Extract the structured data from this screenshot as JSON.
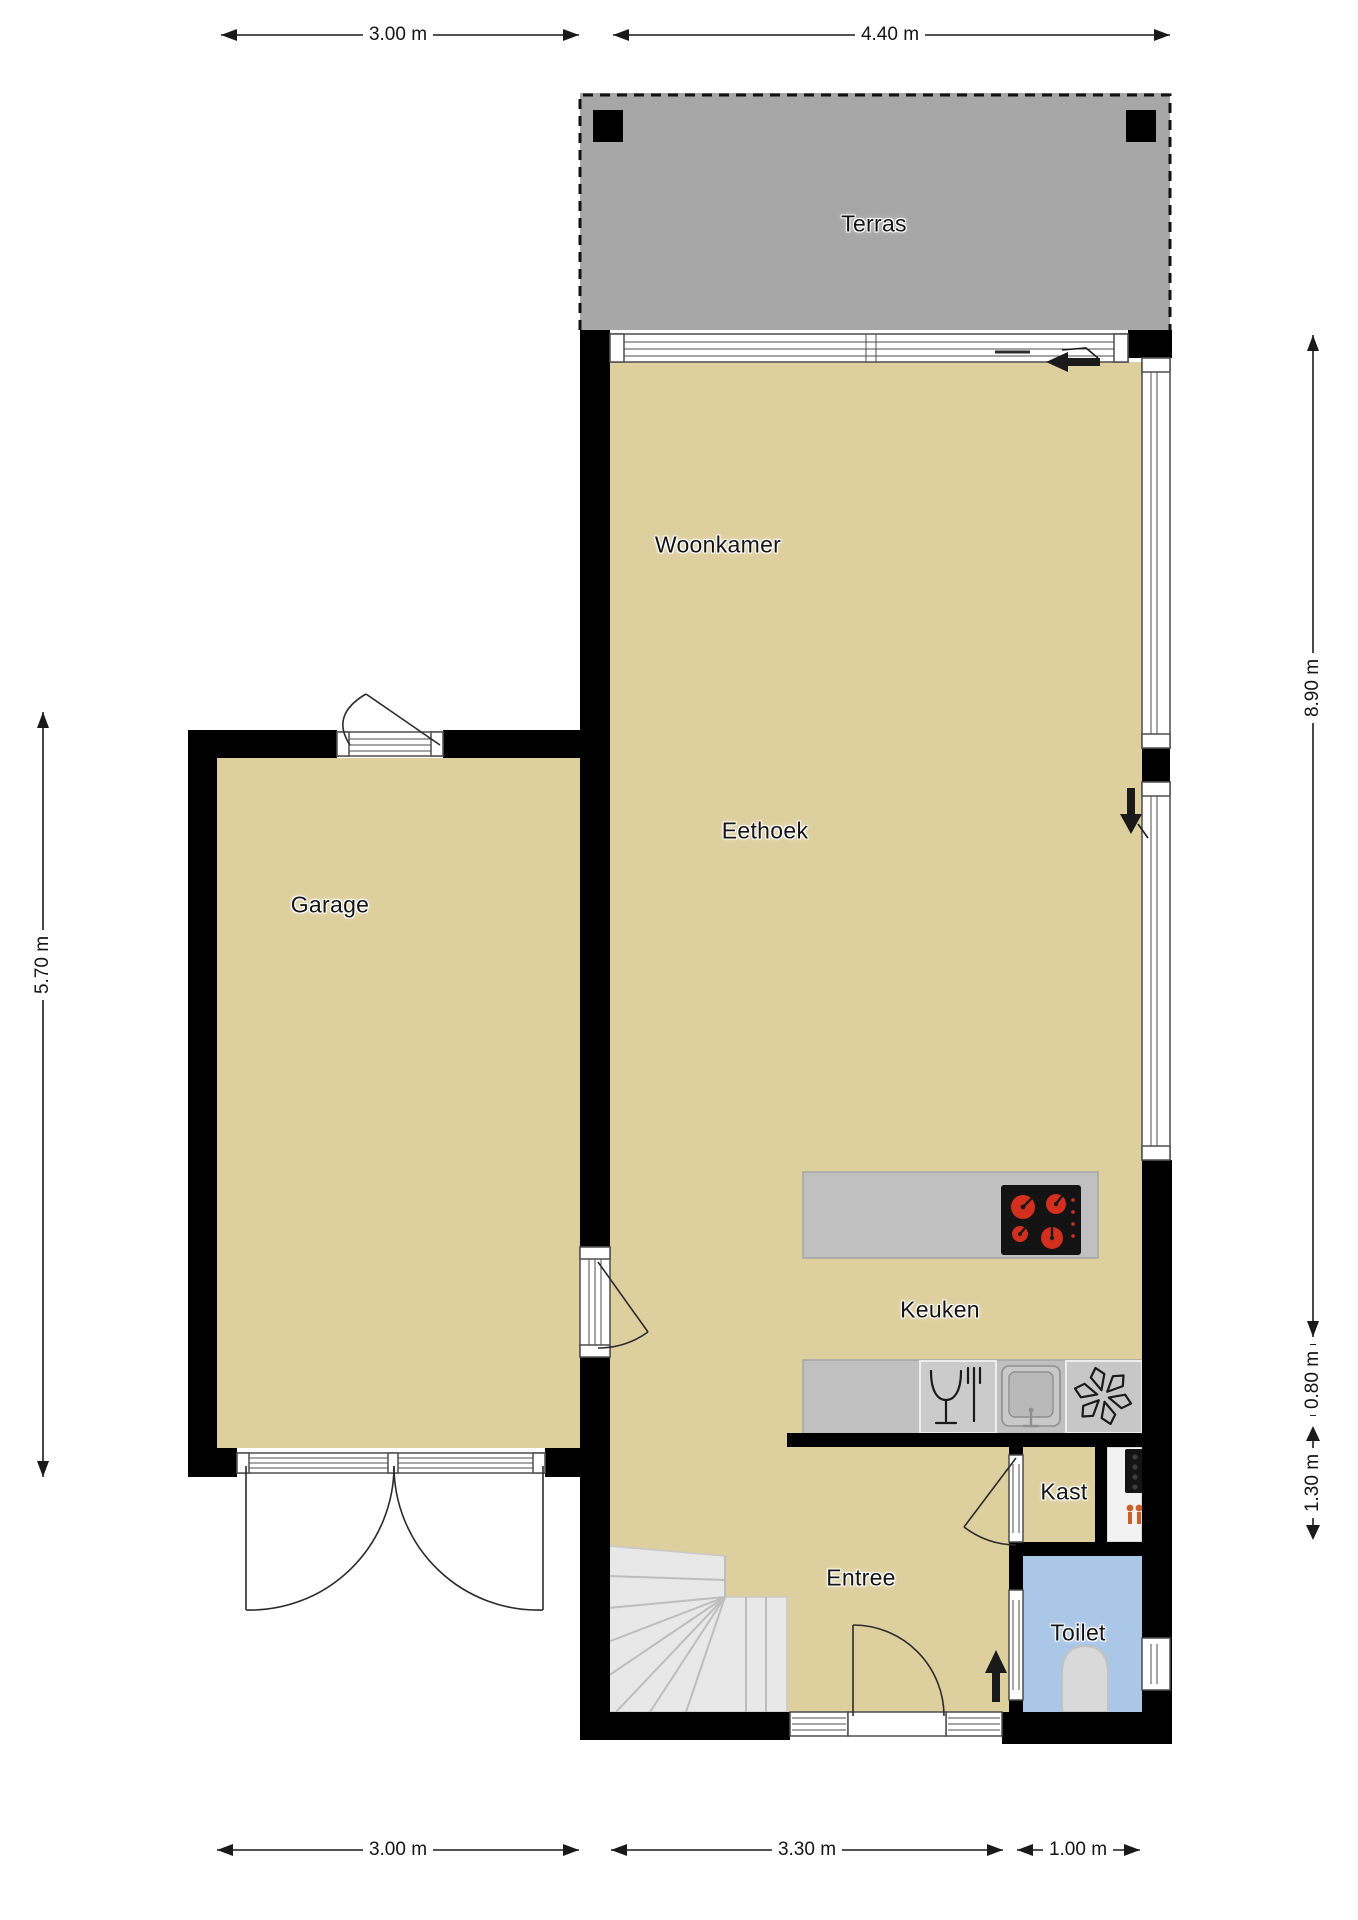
{
  "palette": {
    "wall": "#000000",
    "floor": "#decf9e",
    "terrace": "#a7a7a7",
    "toilet_floor": "#aac7e8",
    "counter": "#c0c0c0",
    "stairs": "#e8e8e8",
    "fixture": "#d9d9d9",
    "burner_red": "#d32f1f",
    "valve_orange": "#cc5f2a",
    "line": "#1a1a1a"
  },
  "rooms": {
    "terras": "Terras",
    "woonkamer": "Woonkamer",
    "eethoek": "Eethoek",
    "garage": "Garage",
    "keuken": "Keuken",
    "kast": "Kast",
    "entree": "Entree",
    "toilet": "Toilet"
  },
  "dimensions": {
    "top": [
      "3.00 m",
      "4.40 m"
    ],
    "bottom": [
      "3.00 m",
      "3.30 m",
      "1.00 m"
    ],
    "left": [
      "5.70 m"
    ],
    "right": [
      "8.90 m",
      "0.80 m",
      "1.30 m"
    ]
  },
  "icons": {
    "cooktop": "black hob with 4 red burners",
    "dishwasher": "wine glass and fork outline",
    "sink": "square basin with tap",
    "extractor_fan": "six-blade fan outline",
    "toilet": "wc pan, rounded top",
    "boiler": "black meter-cabinet unit",
    "valve": "orange tap symbol",
    "stairs": "winder staircase with fanned treads",
    "terrace_posts": "black square posts",
    "entrance_arrows": "solid black direction arrows"
  }
}
